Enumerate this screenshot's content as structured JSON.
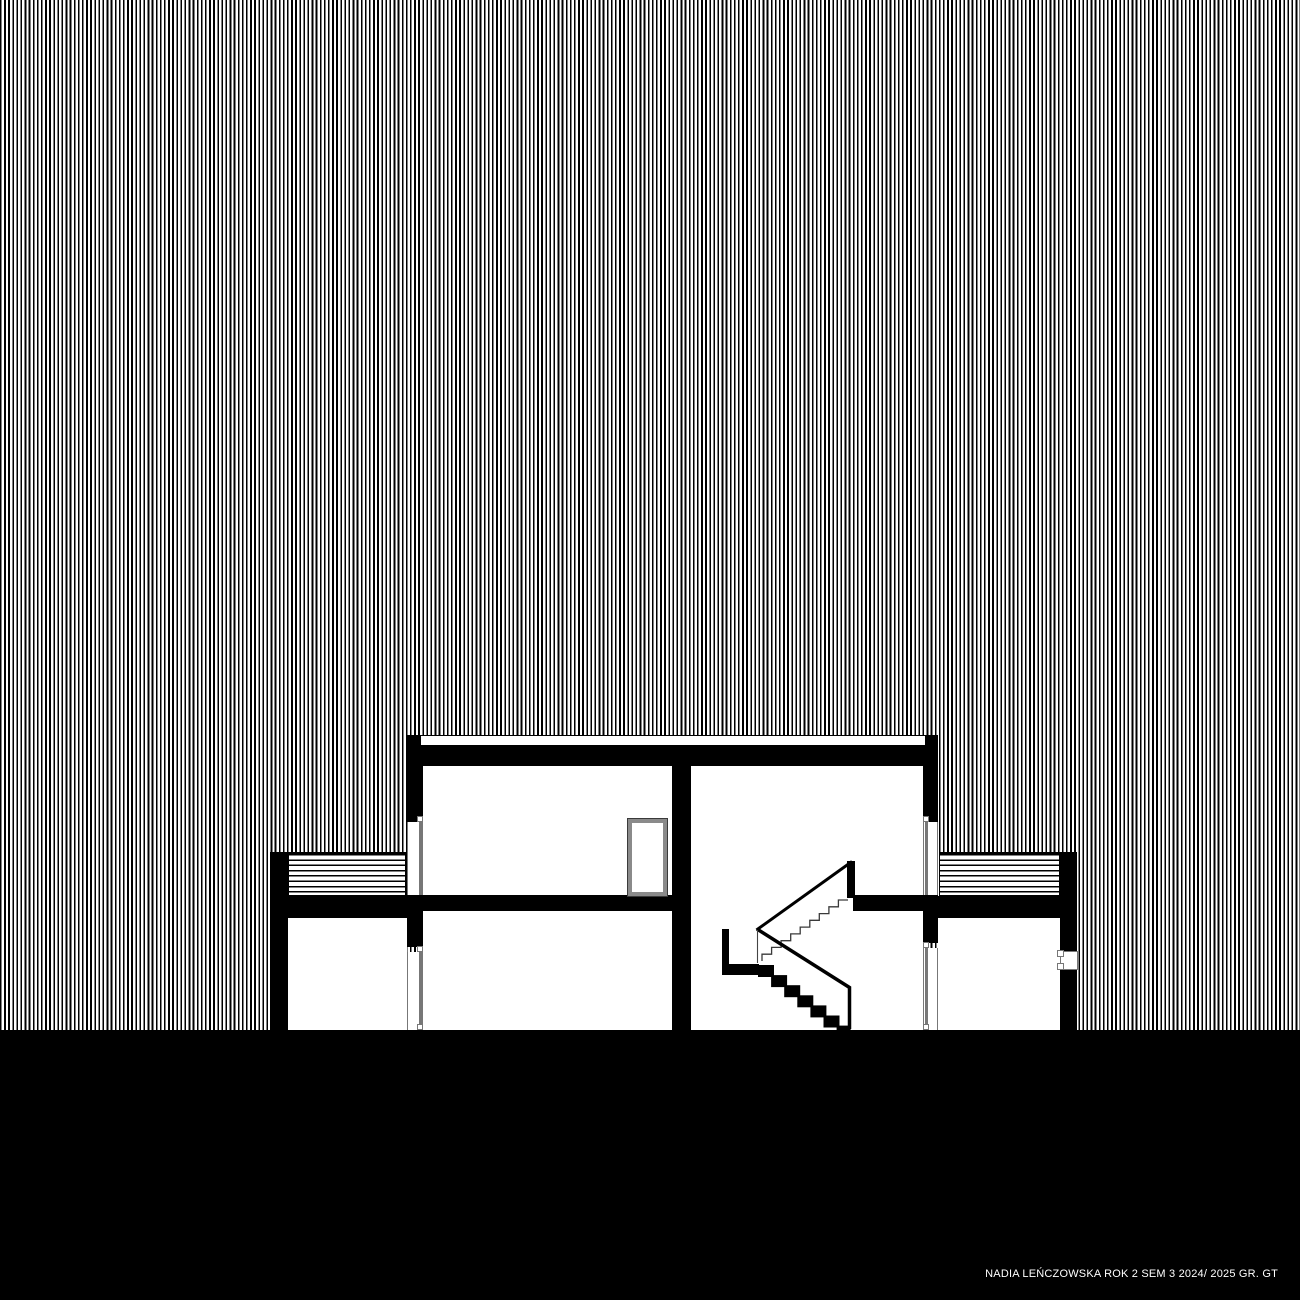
{
  "caption": {
    "text": "NADIA LEŃCZOWSKA ROK 2 SEM 3 2024/ 2025 GR. GT"
  },
  "palette": {
    "ink": "#000000",
    "paper": "#ffffff",
    "frame": "#777777",
    "ground": "#000000",
    "caption_text": "#ffffff"
  },
  "drawing": {
    "type": "architectural building cross-section",
    "background_hatch": "fine vertical lines",
    "wing_roof_hatch": "horizontal lines",
    "storeys_visible": 2,
    "stair": "two-flight stair with mid-height landing"
  }
}
